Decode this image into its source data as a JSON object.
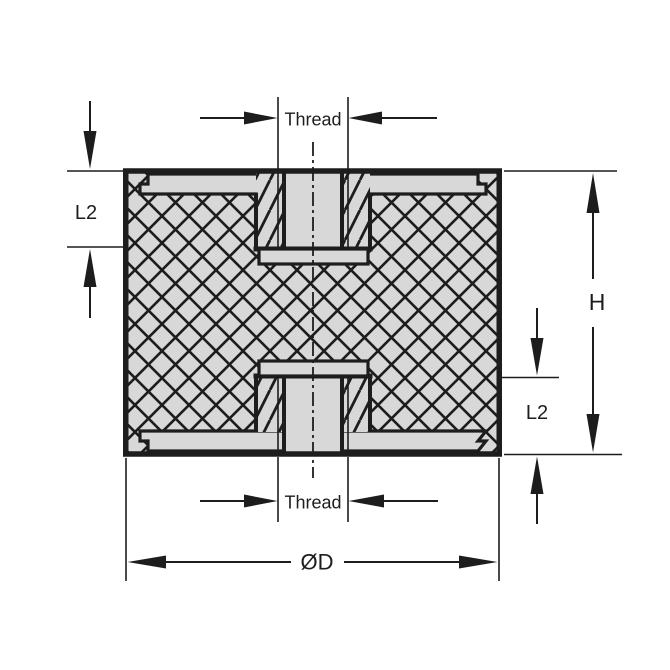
{
  "figure": {
    "labels": {
      "thread_top": "Thread",
      "thread_bottom": "Thread",
      "l2_upper_left": "L2",
      "l2_lower_right": "L2",
      "height": "H",
      "outer_diameter": "ØD"
    },
    "colors": {
      "line": "#1d1d1d",
      "part_fill": "#d8d8d8",
      "background": "#ffffff"
    }
  }
}
